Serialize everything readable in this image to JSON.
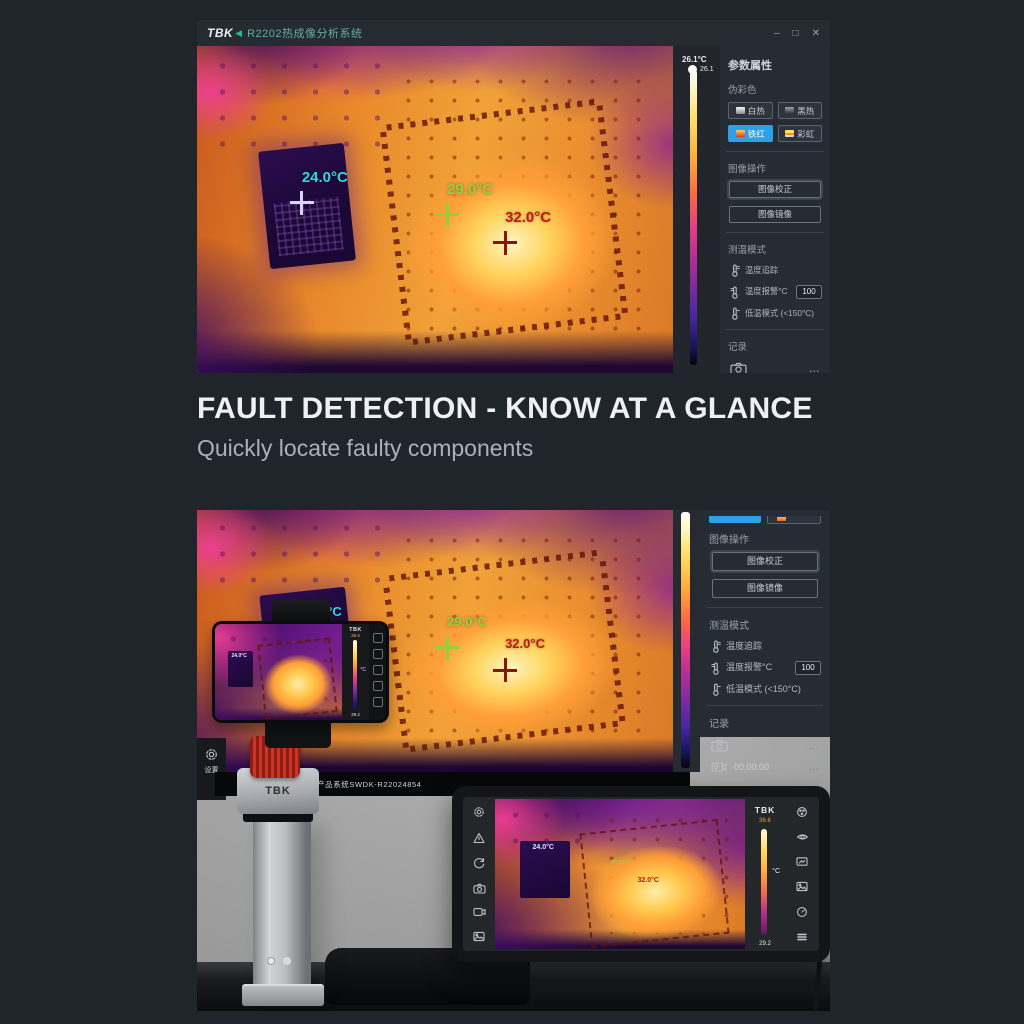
{
  "app": {
    "logo_text": "TBK",
    "logo_arrow": "◀",
    "title": "R2202热成像分析系统",
    "window": {
      "minimize": "–",
      "maximize": "□",
      "close": "✕"
    },
    "scale": {
      "label": "26.1°C",
      "top_value": "26.1"
    },
    "markers": [
      "24.0°C",
      "29.0°C",
      "32.0°C"
    ],
    "panel": {
      "title": "参数属性",
      "pseudo_color": "伪彩色",
      "palettes": [
        "白热",
        "黑热",
        "铁红",
        "彩虹"
      ],
      "image_ops_title": "图像操作",
      "image_ops": [
        "图像校正",
        "图像镜像"
      ],
      "measure_title": "测温模式",
      "measure": [
        {
          "label": "温度追踪"
        },
        {
          "label": "温度报警°C",
          "value": "100"
        },
        {
          "label": "低温模式 (<150°C)"
        }
      ],
      "record_title": "记录",
      "record_time": "00:00:00",
      "more": "..."
    }
  },
  "headline": {
    "title": "FAULT DETECTION - KNOW AT A GLANCE",
    "subtitle": "Quickly locate faulty components"
  },
  "photo": {
    "monitor_label": "产品系统SWDK-R22024854",
    "settings_label": "设置",
    "stand_brand": "TBK",
    "phone": {
      "brand": "TBK",
      "unit": "°C",
      "scale_top": "36.6",
      "scale_bottom": "29.2",
      "marker": "24.0°C"
    },
    "tablet": {
      "brand": "TBK",
      "unit": "°C",
      "scale_top": "36.6",
      "scale_bottom": "29.2"
    }
  },
  "colors": {
    "accent_blue": "#2f9fe8",
    "brand_green": "#2db789",
    "marker_cyan": "#2fd8de",
    "marker_green": "#8ed23e",
    "marker_red": "#c01b10"
  }
}
